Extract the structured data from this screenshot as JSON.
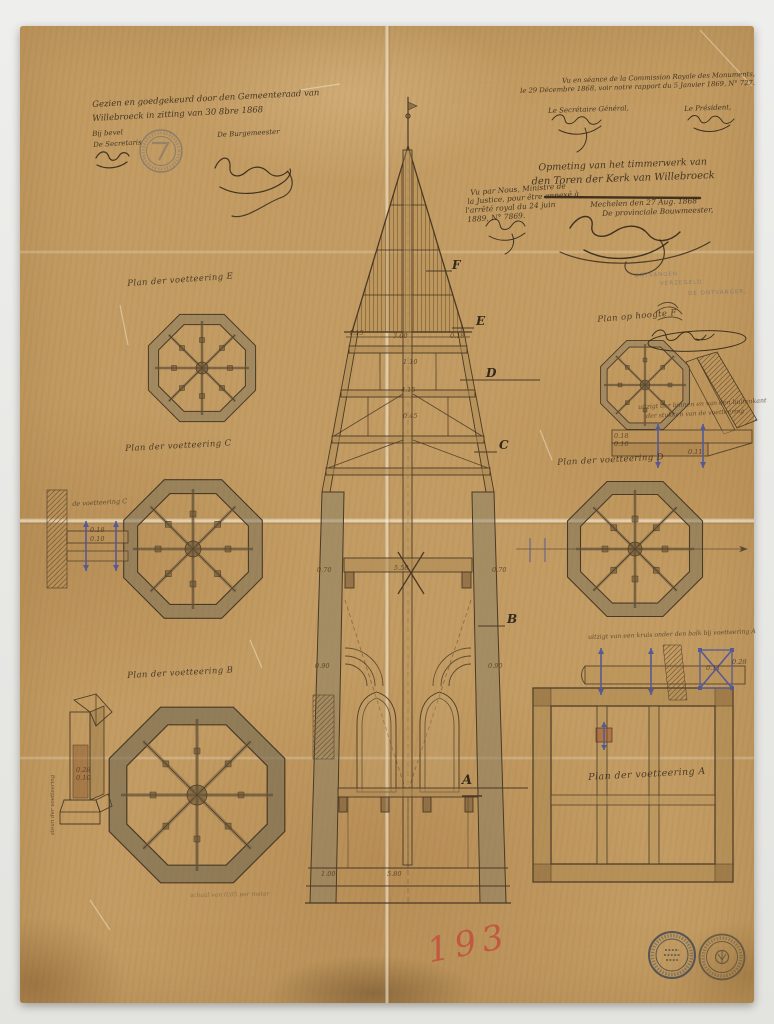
{
  "artifact": {
    "red_number": "193"
  },
  "approval_note": {
    "line1": "Gezien en goedgekeurd door den Gemeenteraad van",
    "line2": "Willebroeck in zitting van 30 8bre 1868",
    "by_order": "Bij bevel",
    "secretary": "De Secretaris",
    "burgomaster": "De Burgemeester"
  },
  "commission_note": {
    "line1": "Vu en séance de la Commission Royale des Monuments,",
    "line2": "le 29 Décembre 1868, voir notre rapport du 5 Janvier 1869, N° 727.",
    "secretary": "Le Secrétaire Général,",
    "president": "Le Président,"
  },
  "title_block": {
    "line1": "Opmeting van het timmerwerk van",
    "line2": "den Toren der Kerk van Willebroeck",
    "place_date": "Mechelen den 27 Aug. 1868",
    "author": "De provinciale Bouwmeester,"
  },
  "minister_note": {
    "line1": "Vu par Nous, Ministre de",
    "line2": "la Justice, pour être annexé à",
    "line3": "l'arrêté royal du 24 juin",
    "line4": "1889, N° 7869."
  },
  "receiver_stamp": {
    "line1": "ONTVANGEN",
    "line2": "VERZEGELD",
    "line3": "DE ONTVANGER,"
  },
  "plan_labels": {
    "e": "Plan der voetteering E",
    "c": "Plan der voetteering C",
    "b": "Plan der voetteering B",
    "f": "Plan op hoogte F",
    "d": "Plan der voetteering D",
    "a": "Plan der voetteering A"
  },
  "annotations": {
    "right_mid_1": "uitzigt der binnen en van den buitenkant",
    "right_mid_2": "der stukken van de voetteering",
    "right_low": "uitzigt van een kruis onder den balk bij voetteering A",
    "left_detail": "de voetteering C",
    "post_detail": "steun der voetteering",
    "scale_note": "schaal van 0,05 per meter"
  },
  "section_letters": {
    "f": "F",
    "e": "E",
    "d": "D",
    "c": "C",
    "b": "B",
    "a": "A"
  },
  "dims": {
    "d360": "3.60",
    "d115": "1.15",
    "d018": "0.18",
    "d110": "1.10",
    "d415": "4.15",
    "d045": "0.45",
    "d070": "0.70",
    "d558": "5.58",
    "d090": "0.90",
    "d100": "1.00",
    "d580": "5.80",
    "d010": "0.10",
    "d028": "0.28",
    "d011": "0.11"
  },
  "colors": {
    "paper": "#c39c63",
    "ink": "#3f3122",
    "red": "#c2503c",
    "bolt": "#565a94"
  }
}
